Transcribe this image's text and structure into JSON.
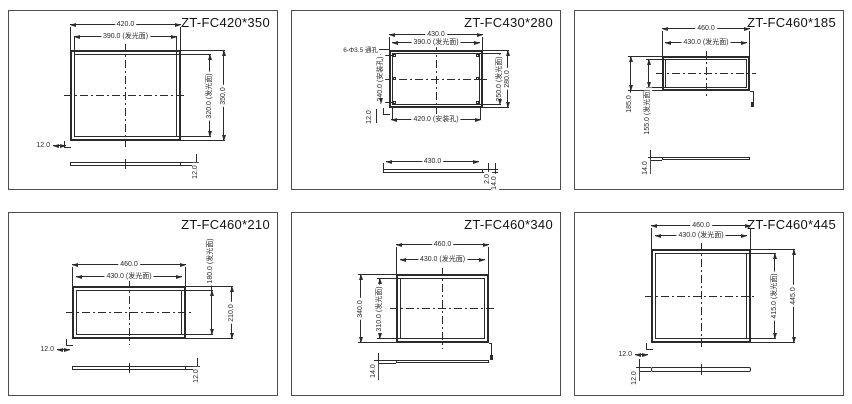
{
  "colors": {
    "background": "#ffffff",
    "line": "#2b2b2b",
    "cell_border": "#4d4d4d",
    "title": "#111111"
  },
  "panels": [
    {
      "title": "ZT-FC420*350",
      "dims": {
        "outer_width": "420.0",
        "light_width": "390.0 (发光面)",
        "light_height": "320.0 (发光面)",
        "outer_height": "350.0",
        "corner_offset": "12.0",
        "thickness": "12.0"
      }
    },
    {
      "title": "ZT-FC430*280",
      "dims": {
        "outer_width": "430.0",
        "light_width": "390.0 (发光面)",
        "holes_note": "6-Φ3.5 通孔",
        "holes_height": "240.0 (安装孔)",
        "light_height": "250.0 (发光面)",
        "outer_height": "280.0",
        "holes_width": "420.0 (安装孔)",
        "corner_offset": "12.0",
        "side_width": "430.0",
        "edge_thickness": "2.0",
        "thickness": "14.0"
      }
    },
    {
      "title": "ZT-FC460*185",
      "dims": {
        "outer_width": "460.0",
        "light_width": "430.0 (发光面)",
        "outer_height": "185.0",
        "light_height": "155.0 (发光面)",
        "thickness": "14.0"
      }
    },
    {
      "title": "ZT-FC460*210",
      "dims": {
        "outer_width": "460.0",
        "light_width": "430.0 (发光面)",
        "light_height": "180.0 (发光面)",
        "outer_height": "210.0",
        "corner_offset": "12.0",
        "thickness": "12.0"
      }
    },
    {
      "title": "ZT-FC460*340",
      "dims": {
        "outer_width": "460.0",
        "light_width": "430.0 (发光面)",
        "outer_height": "340.0",
        "light_height": "310.0 (发光面)",
        "thickness": "14.0"
      }
    },
    {
      "title": "ZT-FC460*445",
      "dims": {
        "outer_width": "460.0",
        "light_width": "430.0 (发光面)",
        "light_height": "415.0 (发光面)",
        "outer_height": "445.0",
        "corner_offset": "12.0",
        "thickness": "12.0"
      }
    }
  ]
}
